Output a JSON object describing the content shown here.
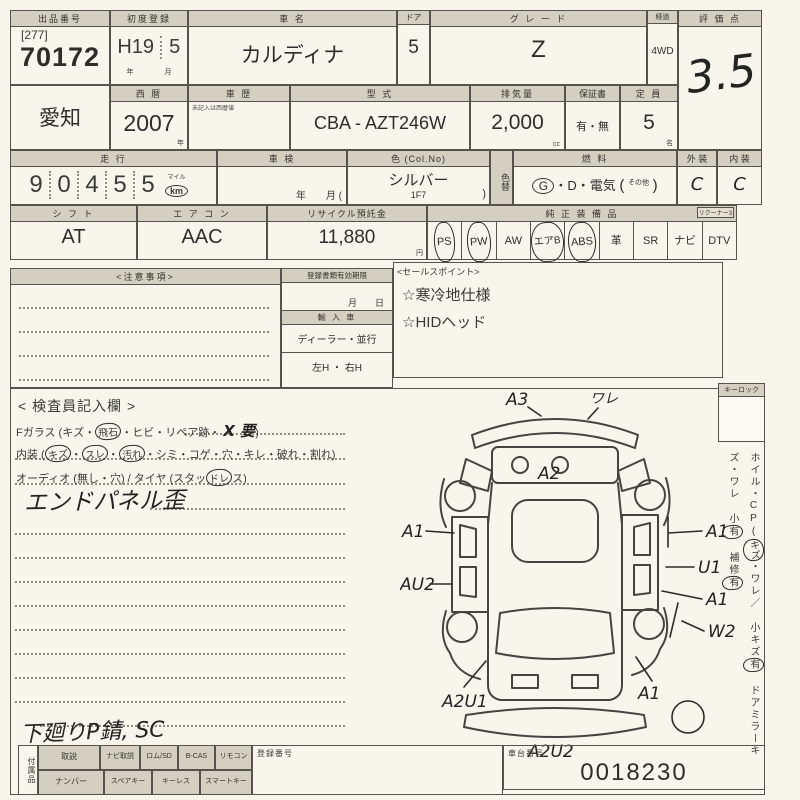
{
  "row1": {
    "lot_label": "出品番号",
    "lot_bracket": "[277]",
    "lot_number": "70172",
    "firstreg_label": "初度登録",
    "firstreg_era": "H19",
    "firstreg_month": "5",
    "unit_year": "年",
    "unit_month": "月",
    "name_label": "車 名",
    "name_value": "カルディナ",
    "door_label": "ドア",
    "door_value": "5",
    "grade_label": "グ レ ー ド",
    "grade_value": "Z",
    "drive_label": "経過",
    "drive_value": "4WD",
    "score_label": "評 価 点",
    "score_value": "3.5"
  },
  "row2": {
    "prefecture": "愛知",
    "year_label": "西 暦",
    "year_value": "2007",
    "unit_year": "年",
    "history_label": "車 歴",
    "history_note": "未記入は西暦値",
    "model_label": "型 式",
    "model_value": "CBA - AZT246W",
    "disp_label": "排気量",
    "disp_value": "2,000",
    "disp_unit": "cc",
    "warranty_label": "保証書",
    "warranty_value": "有・無",
    "cap_label": "定 員",
    "cap_value": "5",
    "cap_unit": "名"
  },
  "row3": {
    "mileage_label": "走 行",
    "mileage_digits": [
      "9",
      "0",
      "4",
      "5",
      "5"
    ],
    "mileage_mile": "マイル",
    "mileage_km": "km",
    "shaken_label": "車 検",
    "shaken_units": "年　　月 (",
    "color_label": "色 (Col.No)",
    "color_value": "シルバー",
    "color_code": "1F7",
    "color_paren": ")",
    "colorchg_label": "色替",
    "fuel_label": "燃 料",
    "fuel_g": "G",
    "fuel_rest": "・D・電気",
    "fuel_open": "(",
    "fuel_other": "その他",
    "fuel_close": ")",
    "ext_label": "外 装",
    "ext_value": "C",
    "int_label": "内 装",
    "int_value": "C"
  },
  "row4": {
    "shift_label": "シ フ ト",
    "shift_value": "AT",
    "ac_label": "エ ア コ ン",
    "ac_value": "AAC",
    "recycle_label": "リサイクル預託金",
    "recycle_value": "11,880",
    "recycle_unit": "円",
    "equip_label": "純 正 装 備 品",
    "equip_note": "リクーナー3",
    "equip": [
      {
        "label": "PS",
        "circled": true
      },
      {
        "label": "PW",
        "circled": true
      },
      {
        "label": "AW",
        "circled": false
      },
      {
        "label": "エアB",
        "circled": true
      },
      {
        "label": "ABS",
        "circled": true
      },
      {
        "label": "革",
        "circled": false
      },
      {
        "label": "SR",
        "circled": false
      },
      {
        "label": "ナビ",
        "circled": false
      },
      {
        "label": "DTV",
        "circled": false
      }
    ]
  },
  "notes": {
    "title": "<注意事項>",
    "regdoc_label": "登録書類有効期限",
    "regdoc_units": "月　　日",
    "import_label": "輸 入 車",
    "import_type": "ディーラー・並行",
    "import_hand": "左H ・ 右H"
  },
  "sales": {
    "title": "<セールスポイント>",
    "points": [
      "☆寒冷地仕様",
      "☆HIDヘッド"
    ]
  },
  "inspector": {
    "title": "< 検査員記入欄 >",
    "glass": {
      "p1": "Fガラス (キズ・",
      "c1": "飛石",
      "p2": "・ヒビ・リペア跡・ ",
      "x": "X 要",
      "p3": ")"
    },
    "interior": {
      "p1": "内装 (",
      "c1": "キズ",
      "d1": "・",
      "c2": "スレ",
      "d2": "・",
      "c3": "汚れ",
      "p2": "・シミ・コゲ・穴・キレ・破れ・割れ)"
    },
    "audio": {
      "p1": "オーディオ (無し・穴) / タイヤ (スタッ",
      "c1": "ドレ",
      "p2": "ス)"
    },
    "hand_note": "エンドパネル歪",
    "hand_bottom": "下廻りP錆, SC"
  },
  "sidebar": {
    "keylock": "キーロック",
    "seg1": "ホイル・CP(",
    "seg1c": "キズ",
    "seg2": "・ワレ／ 小キズ",
    "seg2c": "有",
    "seg3": "ドアミラーキズ・ワレ 小",
    "seg3c": "有",
    "seg4": "補修",
    "seg4c": "有"
  },
  "diagram": {
    "codes": [
      "A3",
      "ワレ",
      "A2",
      "A1",
      "AU2",
      "A2U1",
      "A2U2",
      "A1",
      "U1",
      "A1",
      "W2",
      "A1"
    ]
  },
  "bottom": {
    "vert_label": "付属品",
    "rowA": [
      "取説",
      "ナビ取説",
      "ロム/SD",
      "B-CAS",
      "リモコン"
    ],
    "rowB": [
      "ナンバー",
      "スペアキー",
      "キーレス",
      "スマートキー"
    ],
    "reg_label": "登録番号",
    "chassis_label": "車台番号",
    "chassis_value": "0018230"
  }
}
